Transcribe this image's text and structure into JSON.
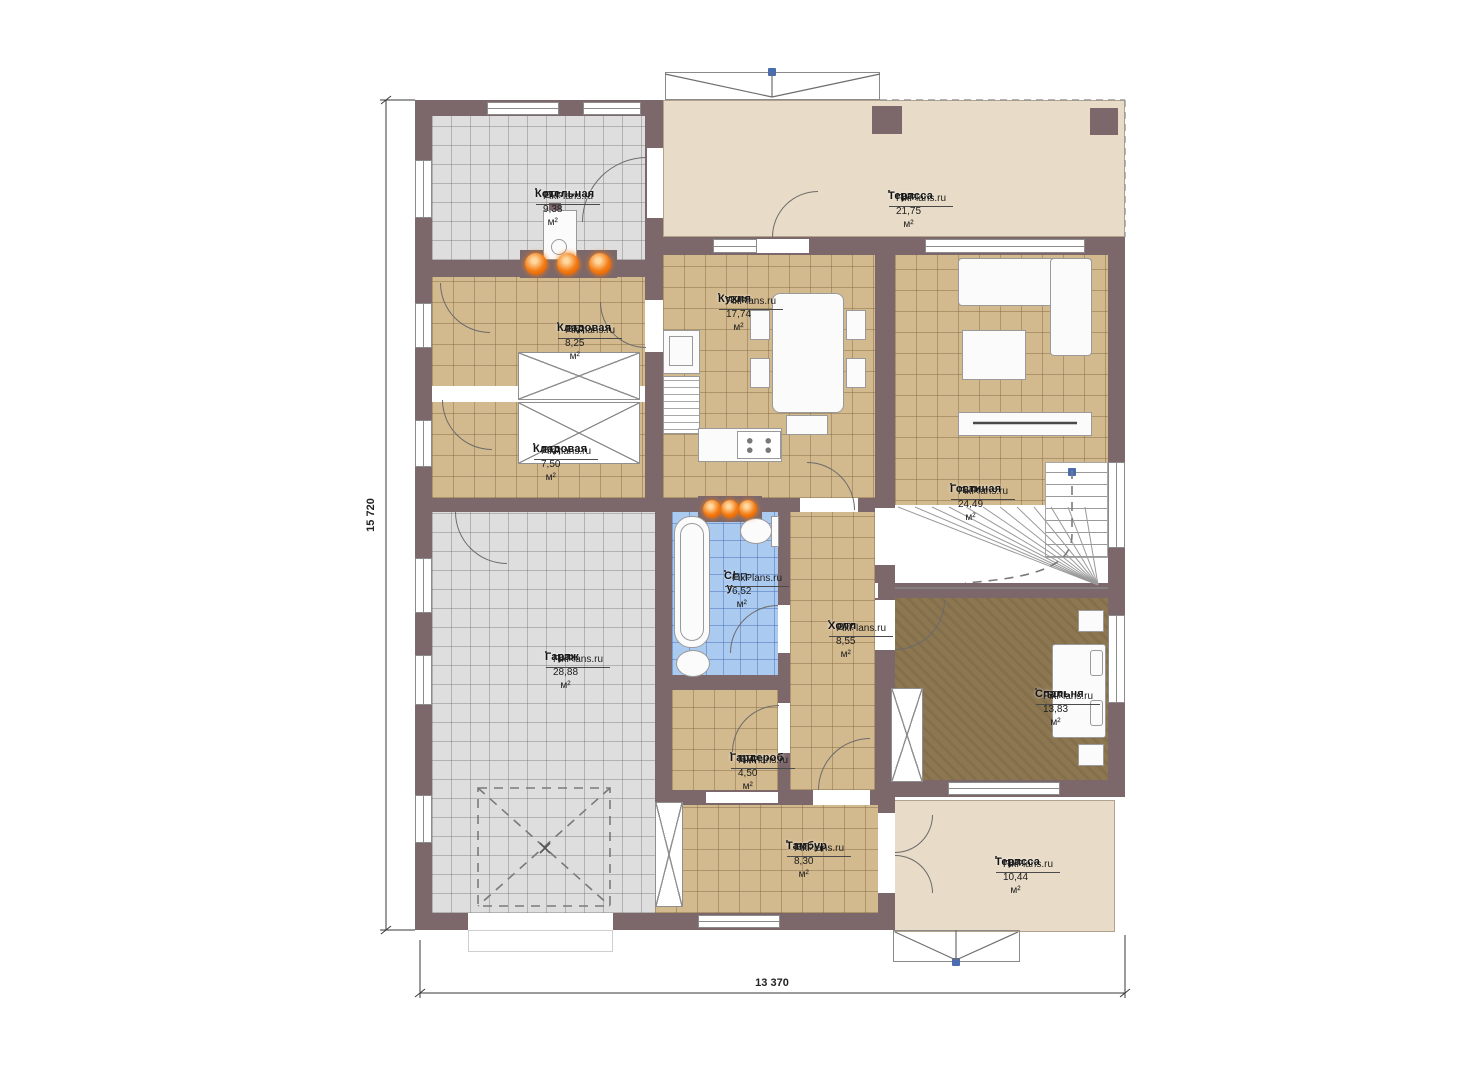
{
  "watermark": "FixPlans.ru",
  "dimensions": {
    "vertical": "15 720",
    "horizontal": "13 370"
  },
  "colors": {
    "wall": "#7c686b",
    "floor_tile_tan": "#d3b98e",
    "floor_tile_gray": "#dedede",
    "floor_tile_blue": "#abcaf0",
    "floor_terrace": "#e8dbc7",
    "floor_carpet": "#8d7751",
    "heater_orange": "#f47a12",
    "marker_blue": "#4a6cb3"
  },
  "rooms": [
    {
      "key": "boiler",
      "name": "Котельная",
      "area": "ВП: 9,38 м²"
    },
    {
      "key": "terrace-top",
      "name": "Терасса",
      "area": "ВП: 21,75 м²"
    },
    {
      "key": "storage-1",
      "name": "Кладовая",
      "area": "ВП: 8,25 м²"
    },
    {
      "key": "kitchen",
      "name": "Кухня",
      "area": "ВП: 17,74 м²"
    },
    {
      "key": "storage-2",
      "name": "Кладовая",
      "area": "ВП: 7,50 м²"
    },
    {
      "key": "living-room",
      "name": "Гостиная",
      "area": "ВП: 24,49 м²"
    },
    {
      "key": "garage",
      "name": "Гараж",
      "area": "ВП: 28,88 м²"
    },
    {
      "key": "bathroom",
      "name": "С/у",
      "area": "ВП: 6,52 м²"
    },
    {
      "key": "hall",
      "name": "Холл",
      "area": "ВП: 8,55 м²"
    },
    {
      "key": "bedroom",
      "name": "Спальня",
      "area": "ВП: 13,83 м²"
    },
    {
      "key": "wardrobe",
      "name": "Гардероб",
      "area": "ВП: 4,50 м²"
    },
    {
      "key": "vestibule",
      "name": "Тамбур",
      "area": "ВП: 8,30 м²"
    },
    {
      "key": "terrace-bottom",
      "name": "Терасса",
      "area": "ВП: 10,44 м²"
    }
  ]
}
